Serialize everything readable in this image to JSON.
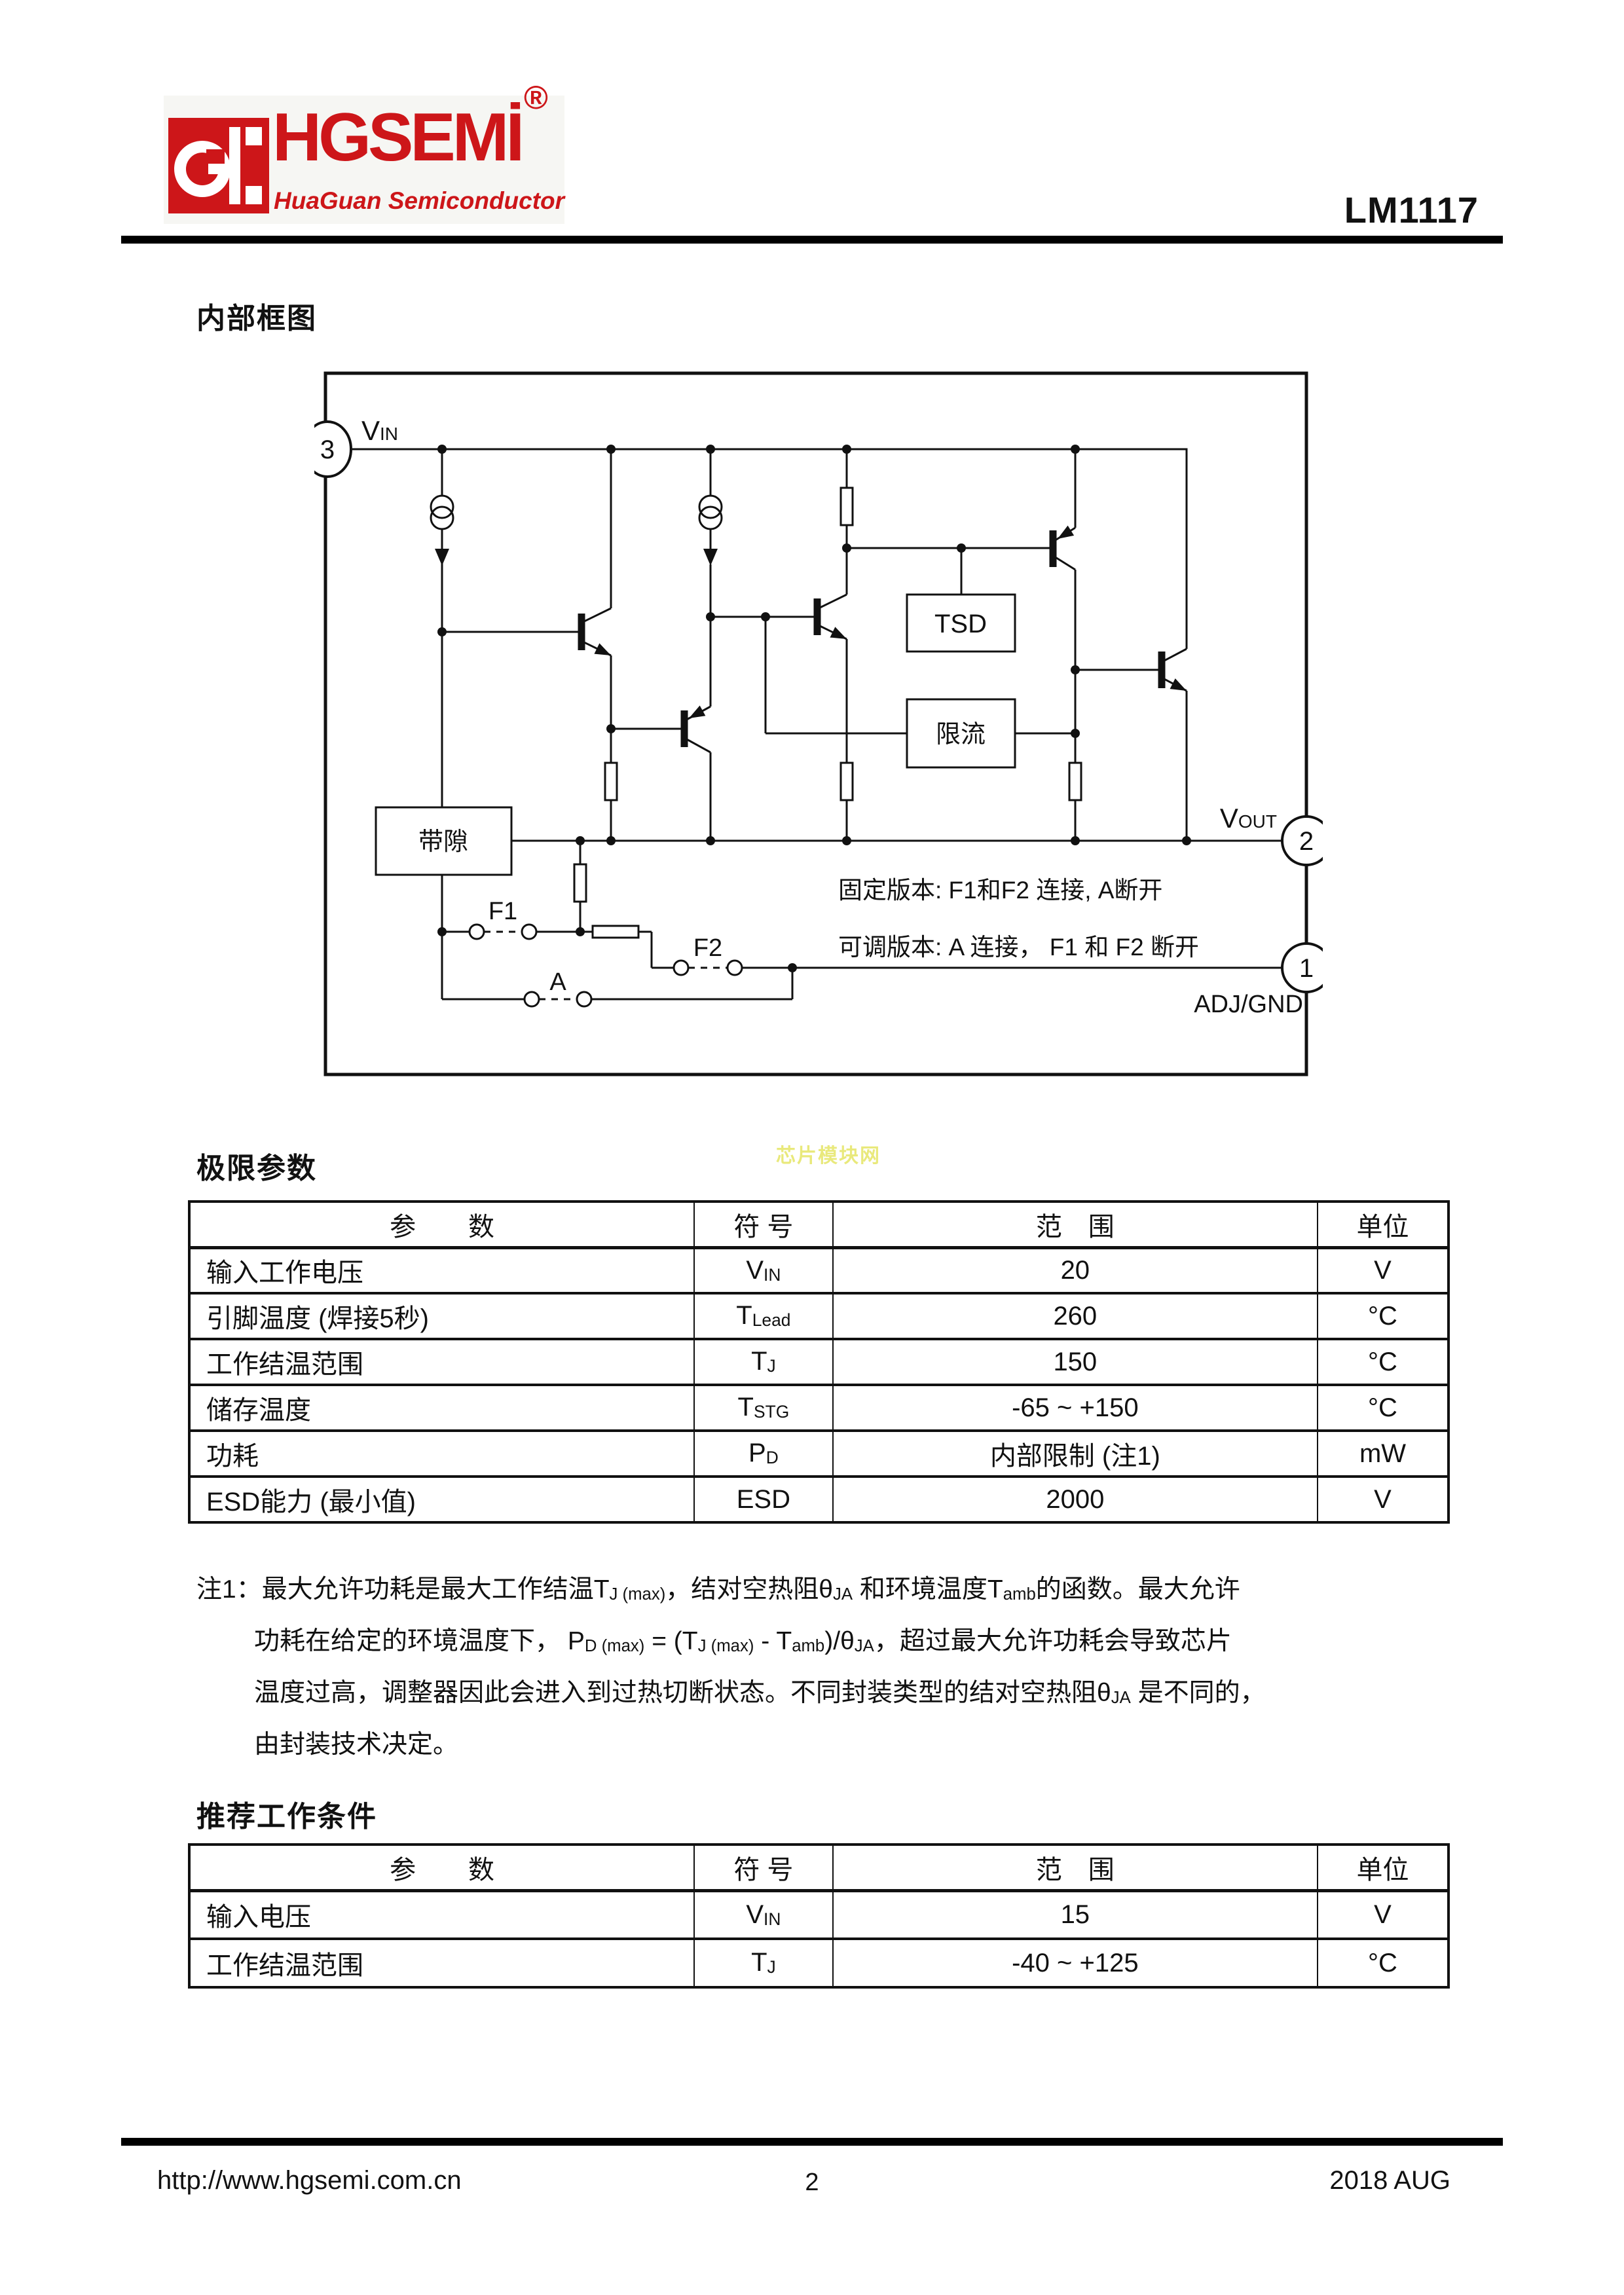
{
  "colors": {
    "brand_red": "#cd1619",
    "watermark_yellow": "#e9e97c",
    "ink": "#111111"
  },
  "header": {
    "logo_text": "HGSEMİ",
    "logo_reg": "®",
    "logo_subtitle": "HuaGuan Semiconductor",
    "part_number": "LM1117"
  },
  "sections": {
    "diagram_title": "内部框图",
    "limits_title": "极限参数",
    "recommended_title": "推荐工作条件"
  },
  "watermark": "芯片模块网",
  "diagram": {
    "pin3": "3",
    "pin2": "2",
    "pin1": "1",
    "vin_main": "V",
    "vin_sub": "IN",
    "vout_main": "V",
    "vout_sub": "OUT",
    "adj_label": "ADJ/GND",
    "tsd_label": "TSD",
    "current_limit_label": "限流",
    "bandgap_label": "带隙",
    "f1_label": "F1",
    "f2_label": "F2",
    "a_label": "A",
    "note_fixed": "固定版本: F1和F2 连接, A断开",
    "note_adjustable": "可调版本: A 连接， F1 和 F2 断开"
  },
  "limits_table": {
    "headers": [
      "参　　数",
      "符 号",
      "范　围",
      "单位"
    ],
    "rows": [
      {
        "param": "输入工作电压",
        "sym": [
          {
            "t": "V"
          },
          {
            "t": "IN",
            "s": 1
          }
        ],
        "range": "20",
        "unit": "V"
      },
      {
        "param": "引脚温度 (焊接5秒)",
        "sym": [
          {
            "t": "T"
          },
          {
            "t": "Lead",
            "s": 1
          }
        ],
        "range": "260",
        "unit": "°C"
      },
      {
        "param": "工作结温范围",
        "sym": [
          {
            "t": "T"
          },
          {
            "t": "J",
            "s": 1
          }
        ],
        "range": "150",
        "unit": "°C"
      },
      {
        "param": "储存温度",
        "sym": [
          {
            "t": "T"
          },
          {
            "t": "STG",
            "s": 1
          }
        ],
        "range": "-65 ~ +150",
        "unit": "°C"
      },
      {
        "param": "功耗",
        "sym": [
          {
            "t": "P"
          },
          {
            "t": "D",
            "s": 1
          }
        ],
        "range": "内部限制 (注1)",
        "unit": "mW"
      },
      {
        "param": "ESD能力 (最小值)",
        "sym": [
          {
            "t": "ESD"
          }
        ],
        "range": "2000",
        "unit": "V"
      }
    ]
  },
  "note": {
    "lines": [
      [
        {
          "t": "注1：最大允许功耗是最大工作结温T"
        },
        {
          "t": "J (max)",
          "s": 1
        },
        {
          "t": "，结对空热阻θ"
        },
        {
          "t": "JA",
          "s": 1
        },
        {
          "t": " 和环境温度T"
        },
        {
          "t": "amb",
          "s": 1
        },
        {
          "t": "的函数。最大允许"
        }
      ],
      [
        {
          "t": "功耗在给定的环境温度下， P"
        },
        {
          "t": "D (max)",
          "s": 1
        },
        {
          "t": " = (T"
        },
        {
          "t": "J (max)",
          "s": 1
        },
        {
          "t": " - T"
        },
        {
          "t": "amb",
          "s": 1
        },
        {
          "t": ")/θ"
        },
        {
          "t": "JA",
          "s": 1
        },
        {
          "t": "，超过最大允许功耗会导致芯片"
        }
      ],
      [
        {
          "t": "温度过高，调整器因此会进入到过热切断状态。不同封装类型的结对空热阻θ"
        },
        {
          "t": "JA",
          "s": 1
        },
        {
          "t": " 是不同的，"
        }
      ],
      [
        {
          "t": "由封装技术决定。"
        }
      ]
    ]
  },
  "rec_table": {
    "headers": [
      "参　　数",
      "符 号",
      "范　围",
      "单位"
    ],
    "rows": [
      {
        "param": "输入电压",
        "sym": [
          {
            "t": "V"
          },
          {
            "t": "IN",
            "s": 1
          }
        ],
        "range": "15",
        "unit": "V"
      },
      {
        "param": "工作结温范围",
        "sym": [
          {
            "t": "T"
          },
          {
            "t": "J",
            "s": 1
          }
        ],
        "range": "-40 ~ +125",
        "unit": "°C"
      }
    ]
  },
  "footer": {
    "url": "http://www.hgsemi.com.cn",
    "page_number": "2",
    "date": "2018 AUG"
  }
}
